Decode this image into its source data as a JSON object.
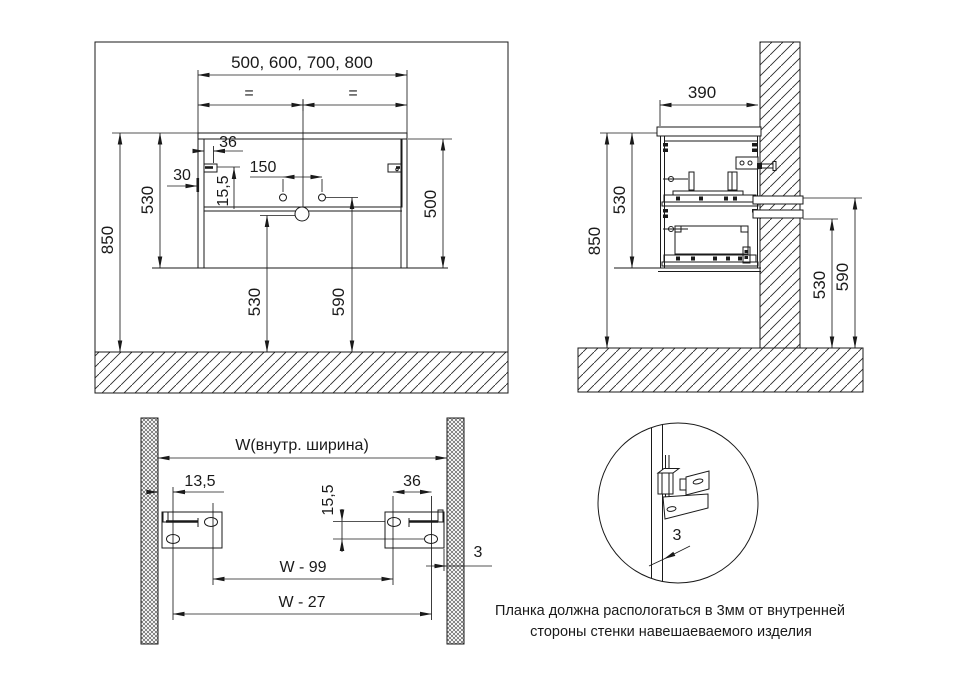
{
  "front_view": {
    "width_options": "500, 600, 700, 800",
    "equal_left": "=",
    "equal_right": "=",
    "bracket_offset": "36",
    "side_offset": "30",
    "bracket_drop": "15,5",
    "hole_spacing": "150",
    "cabinet_height": "530",
    "body_height": "500",
    "total_height": "850",
    "drain_height": "530",
    "pipe_height": "590"
  },
  "side_view": {
    "depth": "390",
    "cabinet_height": "530",
    "total_height": "850",
    "pipe_height_lower": "530",
    "pipe_height_upper": "590"
  },
  "bracket_view": {
    "inner_width": "W(внутр. ширина)",
    "left_offset": "13,5",
    "hole_spacing": "36",
    "vertical_offset": "15,5",
    "width_minus_99": "W - 99",
    "width_minus_27": "W - 27",
    "wall_gap": "3"
  },
  "detail_view": {
    "gap": "3"
  },
  "note": {
    "line1": "Планка должна распологаться в 3мм от внутренней",
    "line2": "стороны стенки навешаеваемого изделия"
  },
  "colors": {
    "line": "#1a1a1a",
    "background": "#ffffff"
  }
}
